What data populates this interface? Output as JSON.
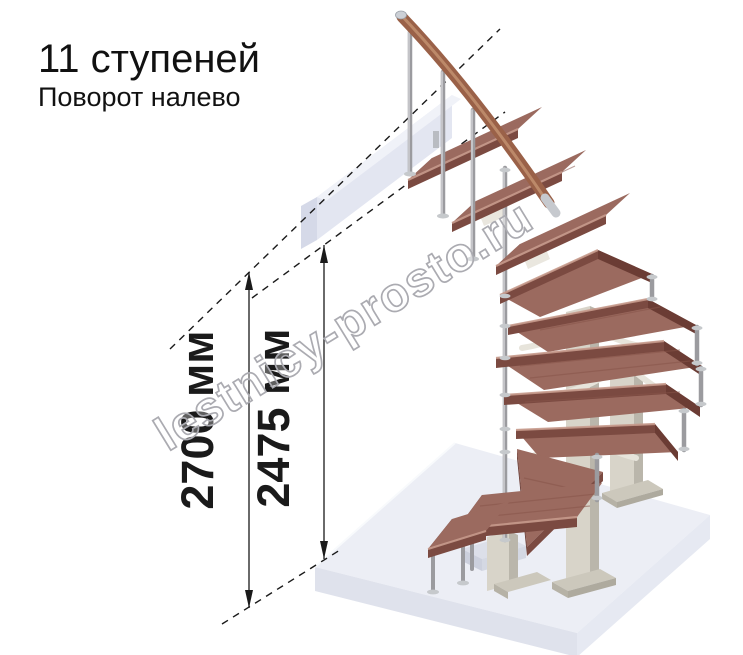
{
  "header": {
    "title": "11 ступеней",
    "subtitle": "Поворот налево"
  },
  "dimensions": {
    "overall_height": "2700 мм",
    "height_to_landing": "2475 мм"
  },
  "watermark": {
    "text": "lestnicy-prosto.ru"
  },
  "scene": {
    "steps_count": 11,
    "turn": "left",
    "elements": [
      "upper-floor-beam",
      "handrail",
      "balusters",
      "wood-treads",
      "winder-treads",
      "support-columns",
      "base-plates",
      "floor-slab",
      "dimension-lines"
    ]
  },
  "colors": {
    "ink": "#1a1a1a",
    "tread_top": "#9b6a5f",
    "tread_front": "#7b4a41",
    "tread_side": "#6b3c34",
    "handrail": "#9a6148",
    "handrail_highlight": "#c29070",
    "metal": "#9b9b9f",
    "metal_light": "#cfcfd3",
    "flange": "#c6c9cc",
    "column_front": "#d8d4c9",
    "column_side": "#bab6ab",
    "plate": "#ccc8bc",
    "plate_side": "#b6b2a6",
    "bracket_cream": "#eae7df",
    "floor_top": "#eceef5",
    "floor_side_left": "#dfe2ec",
    "floor_side_right": "#e6e9f2",
    "beam_face": "#e3e6f1",
    "beam_top": "#f0f2f8",
    "beam_end": "#d5d9e8",
    "watermark_stroke": "#ababb1"
  }
}
